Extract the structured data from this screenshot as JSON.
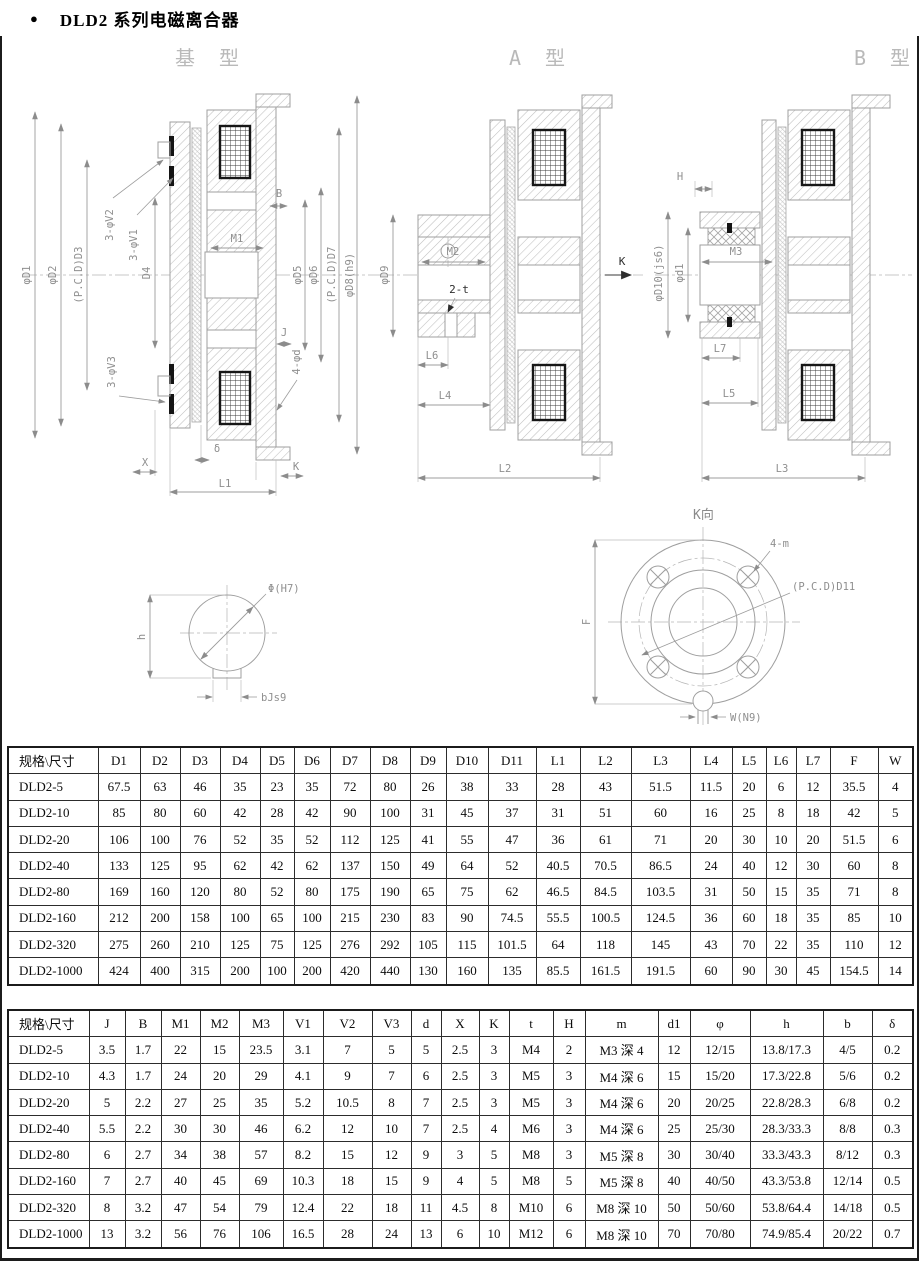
{
  "page": {
    "bullet": "●",
    "title": "DLD2 系列电磁离合器"
  },
  "drawings": {
    "base": {
      "label": "基 型",
      "dim_d1": "φD1",
      "dim_d2": "φD2",
      "dim_d3": "(P.C.D)D3",
      "dim_d4": "D4",
      "dim_v2": "3-φV2",
      "dim_v1": "3-φV1",
      "dim_v3": "3-φV3",
      "dim_m1": "M1",
      "dim_b": "B",
      "dim_d5": "φD5",
      "dim_d6": "φD6",
      "dim_d7": "(P.C.D)D7",
      "dim_d8": "φD8(h9)",
      "dim_j": "J",
      "dim_4d": "4-φd",
      "dim_delta": "δ",
      "dim_x": "X",
      "dim_k": "K",
      "dim_l1": "L1"
    },
    "a_type": {
      "label": "A 型",
      "dim_d9": "φD9",
      "dim_m2": "M2",
      "dim_2t": "2-t",
      "dim_k": "K",
      "dim_l6": "L6",
      "dim_l4": "L4",
      "dim_l2": "L2"
    },
    "b_type": {
      "label": "B 型",
      "dim_h": "H",
      "dim_d10": "φD10(js6)",
      "dim_d1": "φd1",
      "dim_m3": "M3",
      "dim_l7": "L7",
      "dim_l5": "L5",
      "dim_l3": "L3"
    },
    "keyway": {
      "dim_phi": "Φ(H7)",
      "dim_h": "h",
      "dim_b": "bJs9"
    },
    "flange": {
      "label": "K向",
      "dim_4m": "4-m",
      "dim_pcd": "(P.C.D)D11",
      "dim_f": "F",
      "dim_w": "W(N9)"
    }
  },
  "table1": {
    "headers": [
      "规格\\尺寸",
      "D1",
      "D2",
      "D3",
      "D4",
      "D5",
      "D6",
      "D7",
      "D8",
      "D9",
      "D10",
      "D11",
      "L1",
      "L2",
      "L3",
      "L4",
      "L5",
      "L6",
      "L7",
      "F",
      "W"
    ],
    "rows": [
      [
        "DLD2-5",
        "67.5",
        "63",
        "46",
        "35",
        "23",
        "35",
        "72",
        "80",
        "26",
        "38",
        "33",
        "28",
        "43",
        "51.5",
        "11.5",
        "20",
        "6",
        "12",
        "35.5",
        "4"
      ],
      [
        "DLD2-10",
        "85",
        "80",
        "60",
        "42",
        "28",
        "42",
        "90",
        "100",
        "31",
        "45",
        "37",
        "31",
        "51",
        "60",
        "16",
        "25",
        "8",
        "18",
        "42",
        "5"
      ],
      [
        "DLD2-20",
        "106",
        "100",
        "76",
        "52",
        "35",
        "52",
        "112",
        "125",
        "41",
        "55",
        "47",
        "36",
        "61",
        "71",
        "20",
        "30",
        "10",
        "20",
        "51.5",
        "6"
      ],
      [
        "DLD2-40",
        "133",
        "125",
        "95",
        "62",
        "42",
        "62",
        "137",
        "150",
        "49",
        "64",
        "52",
        "40.5",
        "70.5",
        "86.5",
        "24",
        "40",
        "12",
        "30",
        "60",
        "8"
      ],
      [
        "DLD2-80",
        "169",
        "160",
        "120",
        "80",
        "52",
        "80",
        "175",
        "190",
        "65",
        "75",
        "62",
        "46.5",
        "84.5",
        "103.5",
        "31",
        "50",
        "15",
        "35",
        "71",
        "8"
      ],
      [
        "DLD2-160",
        "212",
        "200",
        "158",
        "100",
        "65",
        "100",
        "215",
        "230",
        "83",
        "90",
        "74.5",
        "55.5",
        "100.5",
        "124.5",
        "36",
        "60",
        "18",
        "35",
        "85",
        "10"
      ],
      [
        "DLD2-320",
        "275",
        "260",
        "210",
        "125",
        "75",
        "125",
        "276",
        "292",
        "105",
        "115",
        "101.5",
        "64",
        "118",
        "145",
        "43",
        "70",
        "22",
        "35",
        "110",
        "12"
      ],
      [
        "DLD2-1000",
        "424",
        "400",
        "315",
        "200",
        "100",
        "200",
        "420",
        "440",
        "130",
        "160",
        "135",
        "85.5",
        "161.5",
        "191.5",
        "60",
        "90",
        "30",
        "45",
        "154.5",
        "14"
      ]
    ]
  },
  "table2": {
    "headers": [
      "规格\\尺寸",
      "J",
      "B",
      "M1",
      "M2",
      "M3",
      "V1",
      "V2",
      "V3",
      "d",
      "X",
      "K",
      "t",
      "H",
      "m",
      "d1",
      "φ",
      "h",
      "b",
      "δ"
    ],
    "rows": [
      [
        "DLD2-5",
        "3.5",
        "1.7",
        "22",
        "15",
        "23.5",
        "3.1",
        "7",
        "5",
        "5",
        "2.5",
        "3",
        "M4",
        "2",
        "M3 深 4",
        "12",
        "12/15",
        "13.8/17.3",
        "4/5",
        "0.2"
      ],
      [
        "DLD2-10",
        "4.3",
        "1.7",
        "24",
        "20",
        "29",
        "4.1",
        "9",
        "7",
        "6",
        "2.5",
        "3",
        "M5",
        "3",
        "M4 深 6",
        "15",
        "15/20",
        "17.3/22.8",
        "5/6",
        "0.2"
      ],
      [
        "DLD2-20",
        "5",
        "2.2",
        "27",
        "25",
        "35",
        "5.2",
        "10.5",
        "8",
        "7",
        "2.5",
        "3",
        "M5",
        "3",
        "M4 深 6",
        "20",
        "20/25",
        "22.8/28.3",
        "6/8",
        "0.2"
      ],
      [
        "DLD2-40",
        "5.5",
        "2.2",
        "30",
        "30",
        "46",
        "6.2",
        "12",
        "10",
        "7",
        "2.5",
        "4",
        "M6",
        "3",
        "M4 深 6",
        "25",
        "25/30",
        "28.3/33.3",
        "8/8",
        "0.3"
      ],
      [
        "DLD2-80",
        "6",
        "2.7",
        "34",
        "38",
        "57",
        "8.2",
        "15",
        "12",
        "9",
        "3",
        "5",
        "M8",
        "3",
        "M5 深 8",
        "30",
        "30/40",
        "33.3/43.3",
        "8/12",
        "0.3"
      ],
      [
        "DLD2-160",
        "7",
        "2.7",
        "40",
        "45",
        "69",
        "10.3",
        "18",
        "15",
        "9",
        "4",
        "5",
        "M8",
        "5",
        "M5 深 8",
        "40",
        "40/50",
        "43.3/53.8",
        "12/14",
        "0.5"
      ],
      [
        "DLD2-320",
        "8",
        "3.2",
        "47",
        "54",
        "79",
        "12.4",
        "22",
        "18",
        "11",
        "4.5",
        "8",
        "M10",
        "6",
        "M8 深 10",
        "50",
        "50/60",
        "53.8/64.4",
        "14/18",
        "0.5"
      ],
      [
        "DLD2-1000",
        "13",
        "3.2",
        "56",
        "76",
        "106",
        "16.5",
        "28",
        "24",
        "13",
        "6",
        "10",
        "M12",
        "6",
        "M8 深 10",
        "70",
        "70/80",
        "74.9/85.4",
        "20/22",
        "0.7"
      ]
    ]
  }
}
